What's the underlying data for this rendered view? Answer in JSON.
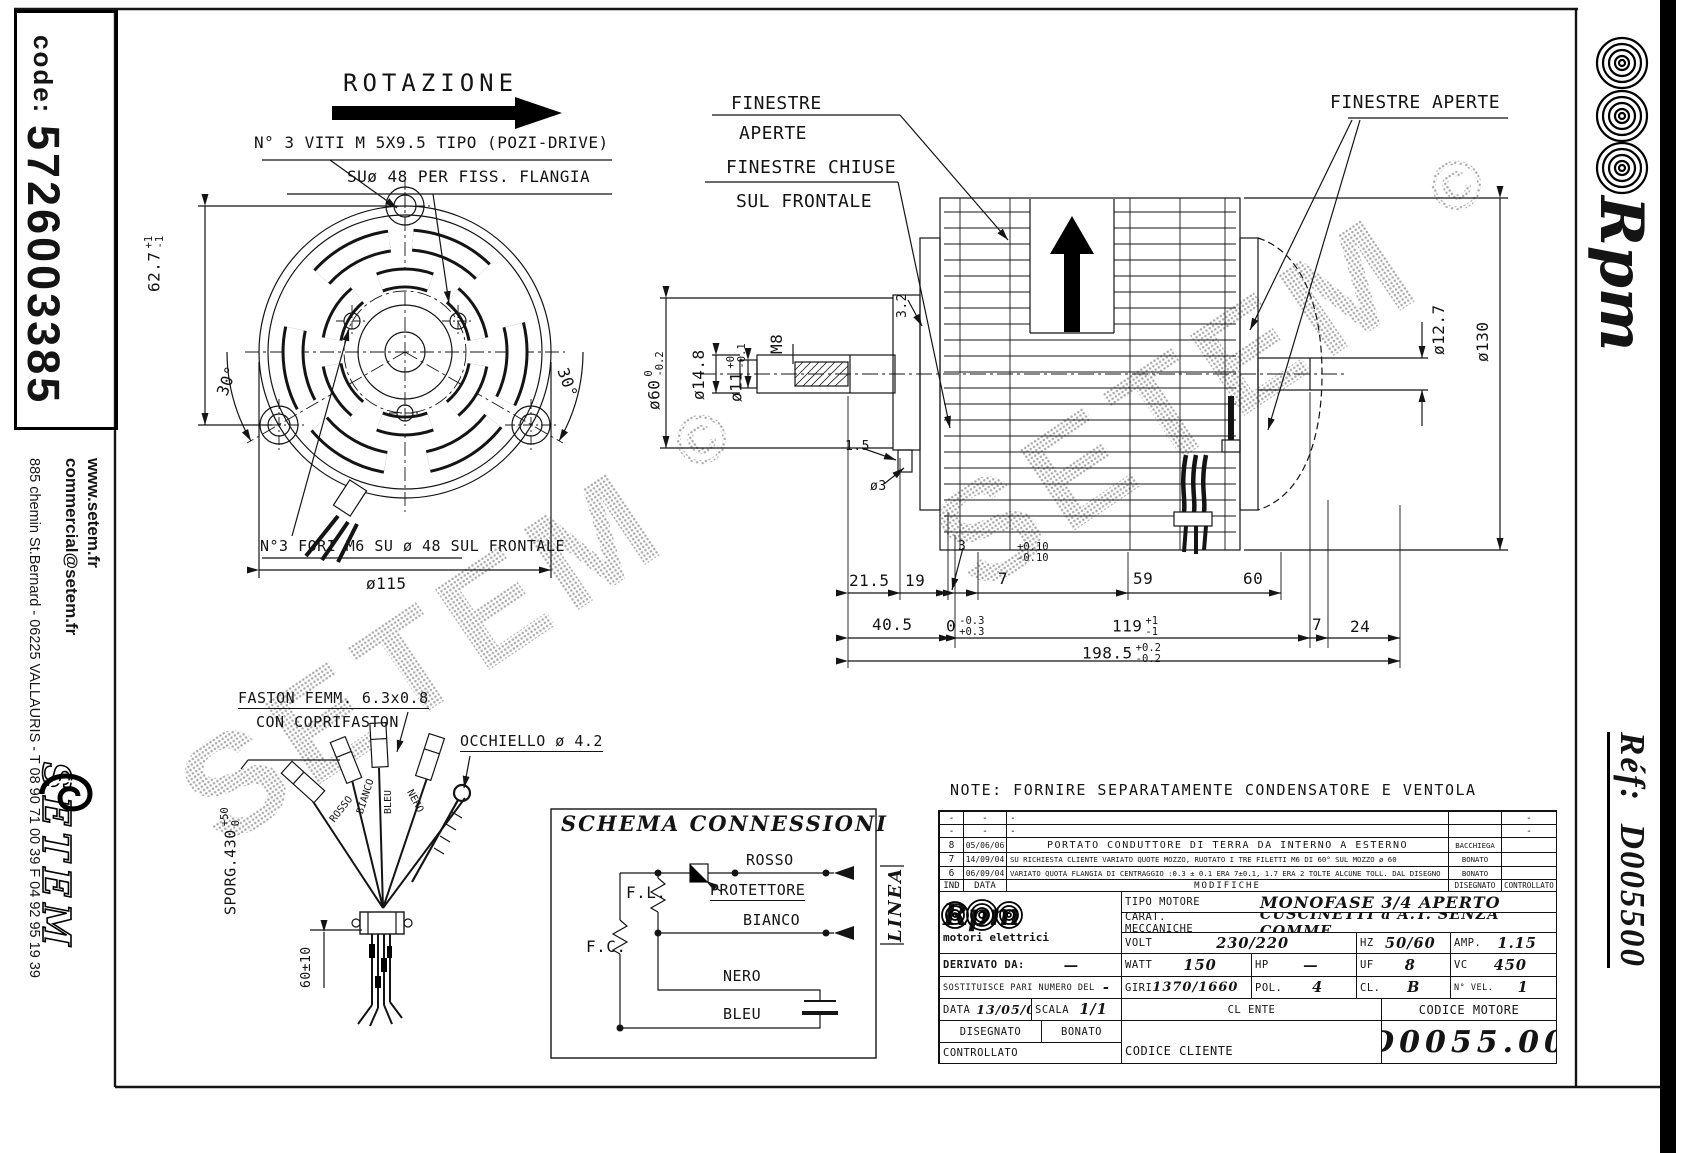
{
  "watermark": {
    "text": "SETEM",
    "mark": "©"
  },
  "left_bar": {
    "code_label": "code:",
    "code_value": "5726003385",
    "website": "www.setem.fr",
    "email": "commercial@setem.fr",
    "address": "885 chemin St.Bernard  -  06225 VALLAURIS  -  T 08 90 71 00 39   F 04 92 95 19 39",
    "logo_text": "SETEM"
  },
  "right_bar": {
    "brand": "Rpm",
    "ref_label": "Réf:",
    "ref_value": "D005500"
  },
  "front_view": {
    "rotazione": "ROTAZIONE",
    "screw_note": "N° 3 VITI M 5X9.5 TIPO (POZI-DRIVE)",
    "flange_note": "SUø 48 PER FISS. FLANGIA",
    "holes_note": "N°3 FORI M6 SU ø 48 SUL FRONTALE",
    "dim_height": {
      "v": "62.7",
      "tp": "+1",
      "tm": "-1"
    },
    "dim_angle_left": "30°",
    "dim_angle_right": "30°",
    "dim_diameter": "ø115"
  },
  "side_view": {
    "finestre_aperte_1": "FINESTRE",
    "finestre_aperte_2": "APERTE",
    "finestre_chiuse_1": "FINESTRE CHIUSE",
    "finestre_chiuse_2": "SUL FRONTALE",
    "finestre_aperte_right": "FINESTRE APERTE",
    "dim_d60": {
      "v": "ø60",
      "tp": "0",
      "tm": "-0.2"
    },
    "dim_d148": "ø14.8",
    "dim_d11": {
      "v": "ø11",
      "tp": "+0",
      "tm": "-0.1"
    },
    "dim_m8": "M8",
    "dim_32": "3.2",
    "dim_15": "1.5",
    "dim_d3": "ø3",
    "dim_3": "3",
    "dim_7": {
      "v": "7",
      "tp": "+0.10",
      "tm": "-0.10"
    },
    "dim_59": "59",
    "dim_60": "60",
    "dim_215": "21.5",
    "dim_19": "19",
    "dim_405": "40.5",
    "dim_0": {
      "v": "0",
      "tp": "-0.3",
      "tm": "+0.3"
    },
    "dim_119": {
      "v": "119",
      "tp": "+1",
      "tm": "-1"
    },
    "dim_7b": "7",
    "dim_24": "24",
    "dim_1985": {
      "v": "198.5",
      "tp": "+0.2",
      "tm": "-0.2"
    },
    "dim_d127": "ø12.7",
    "dim_d130": "ø130"
  },
  "cable": {
    "faston_note_1": "FASTON FEMM. 6.3x0.8",
    "faston_note_2": "CON COPRIFASTON",
    "occhiello_note": "OCCHIELLO ø 4.2",
    "sporg": {
      "v": "SPORG.430",
      "tp": "+50",
      "tm": "0"
    },
    "wire_rosso": "ROSSO",
    "wire_bianco": "BIANCO",
    "wire_bleu": "BLEU",
    "wire_nero": "NERO",
    "dim_len": "60±10"
  },
  "schema": {
    "title": "SCHEMA CONNESSIONI",
    "fl": "F.L.",
    "fc": "F.C.",
    "protettore": "PROTETTORE",
    "rosso": "ROSSO",
    "bianco": "BIANCO",
    "nero": "NERO",
    "bleu": "BLEU",
    "linea": "LINEA"
  },
  "note": "NOTE: FORNIRE SEPARATAMENTE CONDENSATORE E VENTOLA",
  "title_block": {
    "revisions": [
      {
        "ind": "-",
        "date": "-",
        "desc": "-",
        "by": "",
        "ctrl": "-"
      },
      {
        "ind": "-",
        "date": "-",
        "desc": "-",
        "by": "",
        "ctrl": "-"
      },
      {
        "ind": "8",
        "date": "05/06/06",
        "desc": "PORTATO CONDUTTORE DI TERRA DA INTERNO A ESTERNO",
        "by": "BACCHIEGA",
        "ctrl": ""
      },
      {
        "ind": "7",
        "date": "14/09/04",
        "desc": "SU RICHIESTA CLIENTE VARIATO QUOTE MOZZO, RUOTATO I TRE FILETTI M6 DI 60° SUL MOZZO ø 60",
        "by": "BONATO",
        "ctrl": ""
      },
      {
        "ind": "6",
        "date": "06/09/04",
        "desc": "VARIATO QUOTA FLANGIA DI CENTRAGGIO :0.3 ± 0.1 ERA 7±0.1, 1.7 ERA 2 TOLTE ALCUNE TOLL. DAL DISEGNO",
        "by": "BONATO",
        "ctrl": ""
      }
    ],
    "hdr": {
      "ind": "IND",
      "date": "DATA",
      "mod": "MODIFICHE",
      "dis": "DISEGNATO",
      "ctrl": "CONTROLLATO"
    },
    "brand": {
      "name": "Rpm",
      "tagline": "motori elettrici"
    },
    "tipo_label": "TIPO MOTORE",
    "tipo_value": "MONOFASE  3/4  APERTO",
    "carat_label": "CARAT. MECCANICHE",
    "carat_value": "CUSCINETTI  a  A.T.  SENZA COMME",
    "volt_label": "VOLT",
    "volt_value": "230/220",
    "hz_label": "HZ",
    "hz_value": "50/60",
    "amp_label": "AMP.",
    "amp_value": "1.15",
    "derivato_label": "DERIVATO DA:",
    "derivato_value": "—",
    "watt_label": "WATT",
    "watt_value": "150",
    "hp_label": "HP",
    "hp_value": "—",
    "uf_label": "UF",
    "uf_value": "8",
    "vc_label": "VC",
    "vc_value": "450",
    "sost_label": "SOSTITUISCE PARI NUMERO DEL",
    "sost_value": "-",
    "giri_label": "GIRI",
    "giri_value": "1370/1660",
    "pol_label": "POL.",
    "pol_value": "4",
    "cl_label": "CL.",
    "cl_value": "B",
    "nvel_label": "N° VEL.",
    "nvel_value": "1",
    "data_label": "DATA",
    "data_value": "13/05/04",
    "scala_label": "SCALA",
    "scala_value": "1/1",
    "cl_ente_label": "CL ENTE",
    "cod_mot_label": "CODICE MOTORE",
    "cod_mot_value": "D0055.00",
    "dis_label": "DISEGNATO",
    "dis_value": "BONATO",
    "ctrl_label": "CONTROLLATO",
    "cod_cli_label": "CODICE CLIENTE"
  }
}
